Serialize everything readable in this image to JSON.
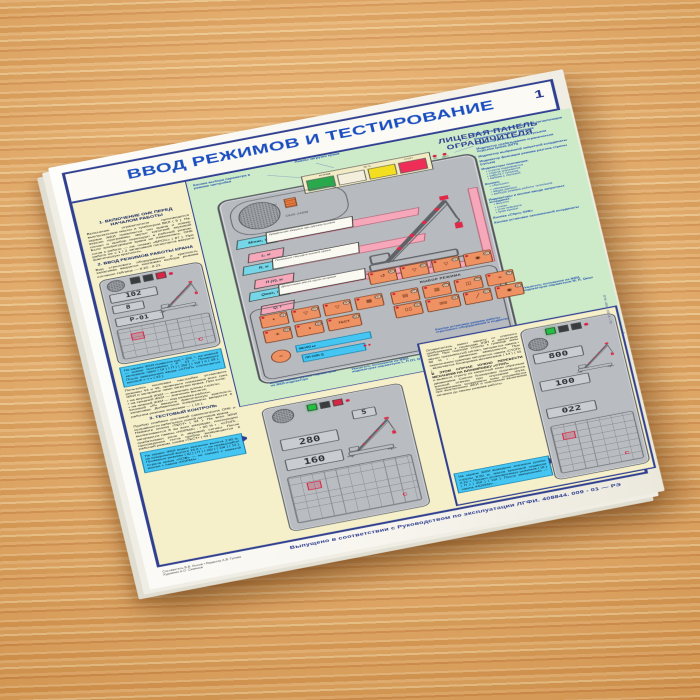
{
  "header": {
    "title": "ВВОД РЕЖИМОВ И ТЕСТИРОВАНИЕ",
    "page_number": "1"
  },
  "logo": {
    "line1": "Прибор ОНК-140",
    "line2": "на автокранах"
  },
  "panel": {
    "title": "ЛИЦЕВАЯ ПАНЕЛЬ\nОГРАНИЧИТЕЛЯ",
    "brand": "ОНК-140М",
    "lamps": {
      "l1": "НОРМА",
      "l2": "90 %",
      "l3": "СТОП",
      "ind1": "ТС",
      "ind2": "ВКЛ",
      "buzzer": "ЗС"
    },
    "params": {
      "m": {
        "tag": "Мmax, т",
        "desc": "Предельная загрузка при данном вылете"
      },
      "l": {
        "tag": "L, м"
      },
      "r": {
        "tag": "R, м",
        "desc": "Показания текущего вылета крюка"
      },
      "p": {
        "tag": "П (У), м"
      },
      "qm": {
        "tag": "Qмах, т",
        "desc": "Допустимая масса груза на крюке"
      },
      "q": {
        "tag": "Q, т"
      }
    },
    "keypad": {
      "mode_label": "ВЫБОР РЕЖИМА",
      "menu": "МЕНЮ ▸▸",
      "lcd": "ЛП СИБ Q",
      "round_n": "40",
      "top": [
        {
          "g": "↺",
          "n": "30"
        },
        {
          "g": "▽",
          "n": "20"
        },
        {
          "g": "▽",
          "n": "10"
        },
        {
          "g": "◉",
          "n": "41"
        }
      ],
      "left1": [
        {
          "g": "◐",
          "n": "34"
        },
        {
          "g": "▽",
          "n": "29"
        },
        {
          "g": "▽",
          "n": "28"
        },
        {
          "g": "▦",
          "n": "35"
        }
      ],
      "left2": [
        {
          "g": "☀",
          "n": "33"
        },
        {
          "g": "◑",
          "n": "36"
        },
        {
          "g": "ТЕСТ",
          "n": "43"
        }
      ],
      "mode1": [
        {
          "g": "▤",
          "n": "21"
        },
        {
          "g": "▥",
          "n": "22"
        },
        {
          "g": "◫",
          "n": "23"
        },
        {
          "g": "≡",
          "n": "24"
        }
      ],
      "mode2": [
        {
          "g": "▯▯",
          "n": "25"
        },
        {
          "g": "▯▯▯",
          "n": "26"
        },
        {
          "g": "╱",
          "n": "27"
        },
        {
          "g": "◉",
          "n": "37"
        }
      ]
    }
  },
  "green_labels": {
    "param_btn": "Кнопка выбора параметра в режиме настройки",
    "lamps": "Лампы загрузки крана"
  },
  "annotations": {
    "right": [
      {
        "t": "Индикатор включения звуковой сигнализации"
      },
      {
        "t": "Индикатор включения питания"
      },
      {
        "t": "Индикатор режима работы с гуськом"
      },
      {
        "t": "Индикатор срабатывания ограничителя подъема крюка (ОГП)"
      },
      {
        "t": "Индикатор выбранной запретной координаты"
      },
      {
        "t": "Индикатор фиксации режима разгона стрелы (гуська)"
      },
      {
        "t": "Индикаторы положения:",
        "b": [
          "стрела поднимается",
          "стрела опускается",
          "работа с гуськом",
          "кабина с люлькой"
        ]
      },
      {
        "t": "Кнопки:",
        "b": [
          "«больше»",
          "«меньше»",
          "ввода данных",
          "выбора режима работы телескопа"
        ]
      },
      {
        "t": "Индикаторы и кнопки ввода запретных координат:",
        "b": [
          "высоты",
          "стены",
          "угла поворота",
          "края крыши"
        ]
      },
      {
        "t": "Кнопка «Сброс ОНК»"
      },
      {
        "t": "Кнопка установки запомненной координаты"
      }
    ]
  },
  "captions": {
    "c1": "Кнопка смены группы параметров на ЖКИ-индикаторе",
    "c2": "Указатель положения на ЖКИ-индикаторах параметров L, П (У), Q",
    "c3": "Указатель положения на ЖКИ-индикаторах параметров М, R, Qмах",
    "k1": "Кнопка установки режима работы стрелового оборудования и подвески",
    "k2": "Кнопка начальной установки параметров"
  },
  "sections": {
    "s1": {
      "title": "1. ВКЛЮЧЕНИЕ ОНК ПЕРЕД НАЧАЛОМ РАБОТЫ",
      "body": "Включение ограничителя производится выключателем массы и тумблером ВКЛ ( 9 ). На экране ЖКИ появляется тип крана и номер версии программы, звучит короткий звуковой сигнал и прибор переходит в рабочий режим. Если конфигурация крана не изменялась, ОНК готов к работе — см. плакат «БРОС» ( 87 ). При работе не с 1 / 2 запасовкой полиспаста введите фактическую кратность."
    },
    "s2": {
      "title": "2. ВВОД РЕЖИМОВ РАБОТЫ КРАНА",
      "body": "Вид стрелового оборудования и кратность запасовки вводятся кнопками выбора режима согласно таблице — 8 20 - 8 21."
    },
    "after_box": "Пользуясь кнопками настройки установите режимы 43 и 46, проверьте показания всех трех ЖКИ и загорание ламп загрузки крана. При этом:\n▪ на верхней ЖКИ — значение длины стрелы;\n▪ на средней ЖКИ — значение вылета;\n▪ на нижней ЖКИ — код режима работы.\nКнопкой «Р» введите фактическую кратность запасовки. Добавочные координаты вводятся в рабочем режиме кнопками — ( 10 ).",
    "s3": {
      "title": "3. ТЕСТОВЫЙ КОНТРОЛЬ",
      "body": "Прибор снабжен системой самоконтроля ОНК и исправности кабельных линий датчиков крана.\nНажмите кнопку •ТЕСТ• ( 43 ). На всех ЖКИ высвечивается 8 во всех разрядах, поочередно загораются лампы •НОРМА• , • 90 % • , •СТОП• , срабатывают реле и звуковой сигнал. После прохождения теста прибор возвращается в рабочий режим, снова •ТЕСТ• ( 43 )."
    }
  },
  "infoboxes": {
    "b1": "На экране ЖКИ появится код < 102 >, на нижней — номер программы < Р - 01 >. Проверьте загорание ламп ( Ш ) ( П ) ( 2Ш ) ( 1Ш ) и ( 28 ). После завершения ввода «СТОП» отключается кнопкой « ч » ( 43 ).",
    "b2": "На экране ЖКИ видно значение вылета 2.80 м, на предельной высоте 16.0 т — не превышайте! Проверьте режимы ( Ш ) ( П ) ( 2Ш ) ( 1Ш ) ( 13 ). Стрела крана «СОВ» — не снимая с нажатой кнопки + лампа •НОРМА• .",
    "b3": "На экране ЖКИ выведено значение длины стрелы 8.00 м, масса крюковой подвески 0.22 т. Предел установленных режимов ( Ш ) ( П ) ( 2Ш ) ( 1Ш ). После завершения — лампа •НОРМА• ."
  },
  "bottom_right": {
    "body": "Ограничитель имеет защиту от опасного приближения к проводам ЛЭП и запретным зонам. При подходе стрелы к границе зоны звучит прерывистый сигнал, загорается лампа • 90 % • , движение замедляется. При пересечении границы загорается лампа •СТОП• , включается блокировка механизмов ( 14 ) ( 15 ).",
    "bold": "В ЭТОМ СЛУЧАЕ НУЖНО ПЕРЕВЕСТИ МЕХАНИЗМ НА БЛОКИРОВКУ «СТОП»",
    "body2": "и вывести стрелу из запретной зоны обратным движением. Снятие блокировки производится кнопкой отмены при опускании груза. Запомненные координаты зоны сохраняются при выключении ЖКИ и повторном включении питания до смены режима работы."
  },
  "devices": {
    "d1": {
      "v1": "102",
      "v2": "8",
      "v3": "Р-01",
      "c": "С"
    },
    "d2": {
      "v0": "5",
      "v1": "280",
      "v2": "160",
      "c": "С"
    },
    "d3": {
      "v1": "800",
      "v2": "100",
      "v3": "022",
      "c": "С"
    }
  },
  "footer": {
    "credits1": "Составитель В.В. Лысов • Редактор А.В. Гусева",
    "credits2": "Художник А.О. Семенов",
    "issued": "Выпущено в соответствии с Руководством по эксплуатации ЛГФИ. 408844. 009 - 01 — РЭ",
    "edge": "ЛГФИ. 408844. 009 - 01 — РЭ"
  }
}
